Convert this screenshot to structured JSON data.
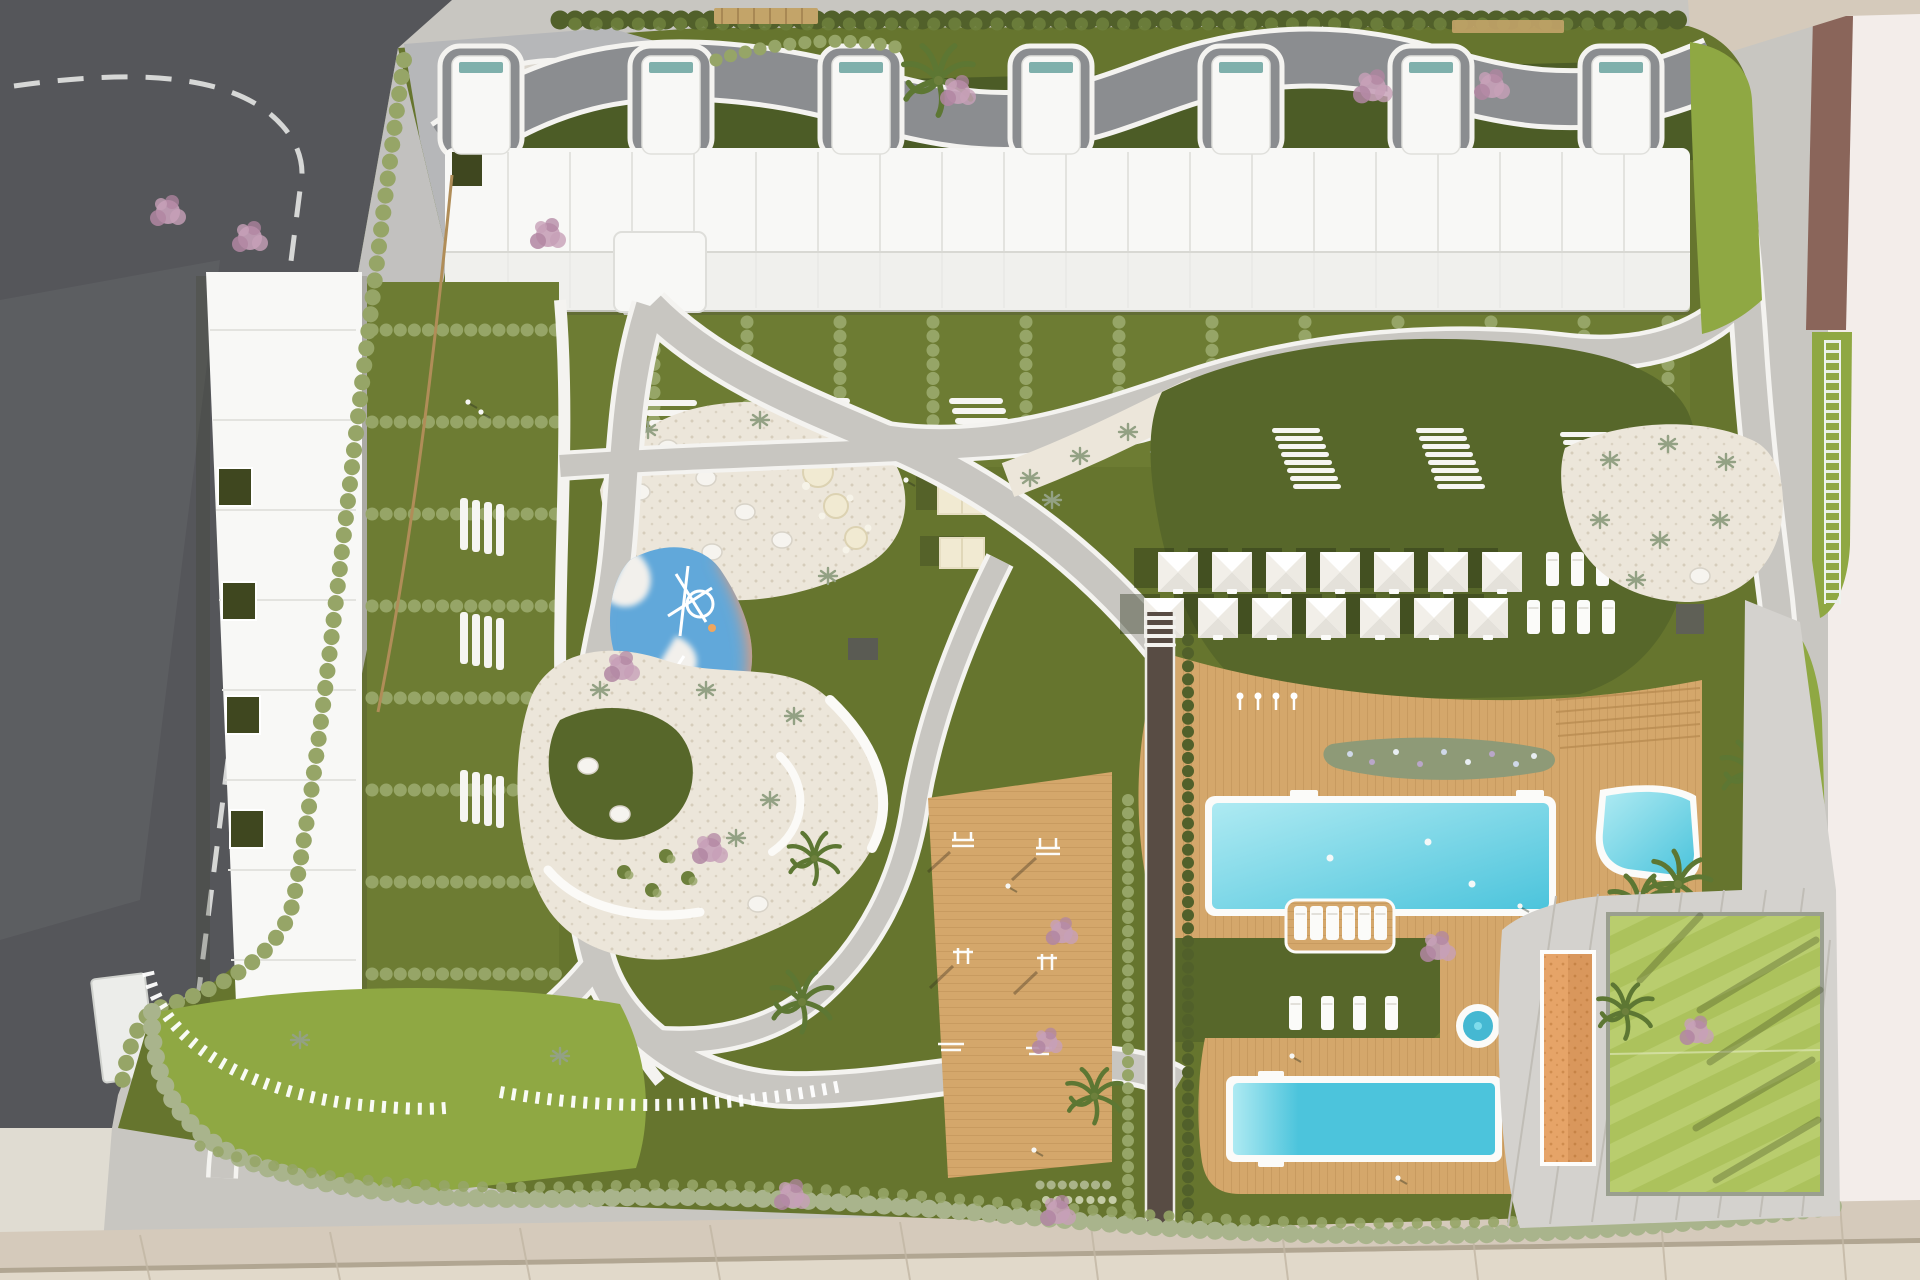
{
  "meta": {
    "title": "Aerial top-down architectural render of a residential complex site plan",
    "view": "top-down 3D render",
    "visible_text": "none"
  },
  "palette": {
    "asphalt": "#55565a",
    "asphaltWear": "#6b6c70",
    "roadline": "#e4e5e3",
    "innerRoad": "#8b8d90",
    "sidewalk": "#d5cabb",
    "sidewalk2": "#e1d9ca",
    "joint": "#c2b7a4",
    "apron": "#e4e1da",
    "plaza": "#f3edea",
    "dirt": "#8a655a",
    "entry": "#b6b7b9",
    "path": "#c8c6c1",
    "pathwhite": "#f4f3f0",
    "lawn": "#66752e",
    "lawnD": "#57672a",
    "lawnDD": "#4c5c26",
    "lawnL": "#8fa843",
    "sport": "#acc25c",
    "sportStripe": "#b9cd6e",
    "hedge": "#51602a",
    "hedgeL": "#96a567",
    "hedgeSage": "#a9b48c",
    "sand": "#ece6da",
    "sandDot": "#d6cdbb",
    "deck": "#d4a76b",
    "deckD": "#b98c52",
    "bldg": "#f8f8f6",
    "bldgLine": "#e3e3df",
    "bldgShade": "#ededea",
    "skylight": "#7fb0ac",
    "patio": "#3f471f",
    "poolA": "#aeeaf2",
    "poolB": "#4cc4dc",
    "jacuzzi": "#45b8d2",
    "playPurple": "#a79bd4",
    "playBlue": "#61a8da",
    "playOrange": "#f29a6d",
    "blossom": "#c7a0b8",
    "blossomD": "#b286a2",
    "palm": "#5d7733",
    "tree": "#6d803c",
    "juniper": "#93a184",
    "cream": "#f1ead2",
    "court": "#e6a468",
    "courtD": "#cf8c4e",
    "concrete": "#d4d2ce",
    "cjoint": "#c0bdb6",
    "track": "#584c44",
    "fence": "#b08d58",
    "perg": "#c3a469",
    "shadow": "rgba(45,55,30,0.30)"
  },
  "features": {
    "buildings": [
      {
        "name": "north-apartment-block",
        "stair_towers": 7,
        "garden_plots": 14
      },
      {
        "name": "west-apartment-block",
        "roof_patios": 4,
        "garden_plots": 10
      }
    ],
    "pools": [
      "main-pool",
      "kids-pool",
      "lap-pool",
      "jacuzzi"
    ],
    "amenities": [
      "playground",
      "sand-garden",
      "outdoor-gym",
      "running-track",
      "petanque-court",
      "sports-lawn",
      "sunbathing-lawn",
      "entry-plaza"
    ],
    "counts": {
      "parasols": 14,
      "sunbeds_upper_lawn": 8,
      "sunbeds_lower_lawn": 4,
      "sunbeds_pool_platform": 6,
      "canopy_tables": 2,
      "picnic_tables": 3,
      "cherry_trees": 12,
      "palm_trees": 8
    }
  }
}
